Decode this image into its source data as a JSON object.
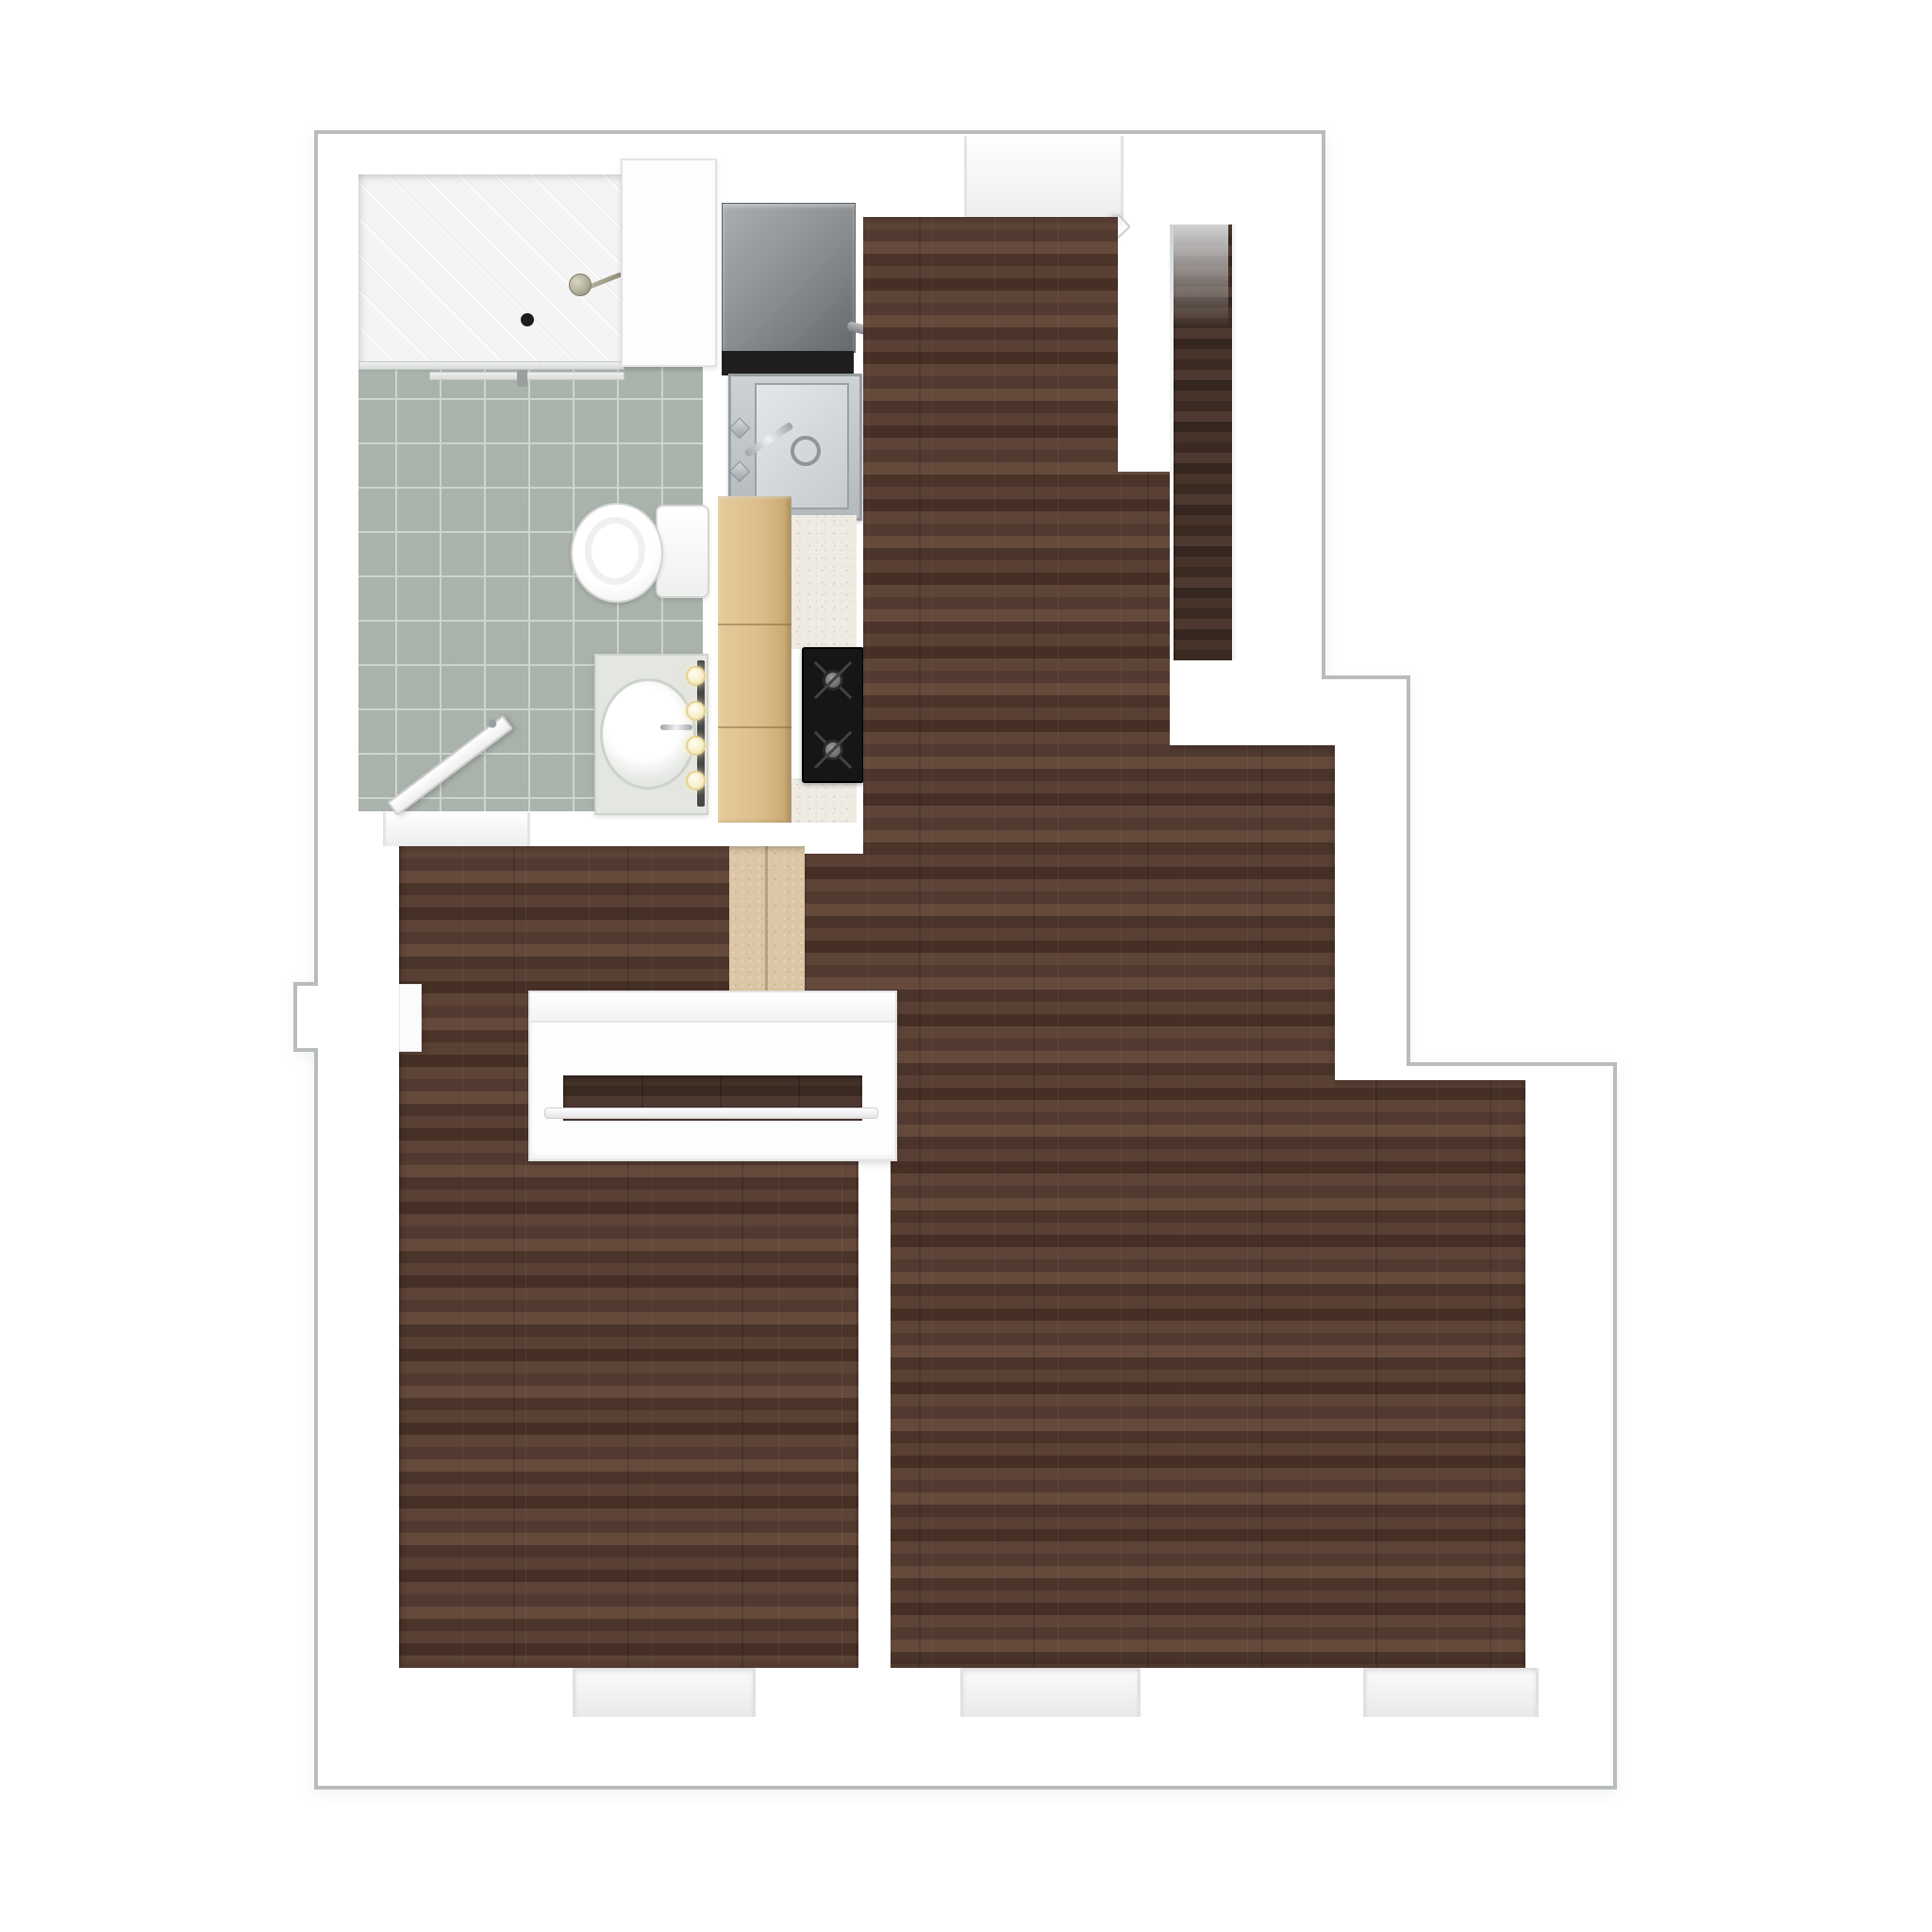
{
  "meta": {
    "title": "Apartment floor plan - 3D top-down dollhouse render",
    "render_style": "photoreal 3D floorplan, no text labels visible",
    "canvas_px": "2048x2048"
  },
  "palette": {
    "background": "#ffffff",
    "outline": "#b9bcbd",
    "wall": "#ffffff",
    "wood_floor": "#573e32",
    "wood_floor_dark": "#3f2e25",
    "tile_floor": "#a9b2ab",
    "tile_grout": "#ced4ce",
    "hall_floor_beige": "#dbc7a6",
    "cabinet_wood": "#ddc08f",
    "countertop": "#eeebe2",
    "stove_black": "#161616",
    "refrigerator_gray": "#85888b",
    "stainless_steel": "#c3c8cb",
    "shower_floor": "#f3f4f3",
    "vanity_top": "#e3e6e1",
    "vanity_bulb": "#fff3cf"
  },
  "rooms": {
    "bathroom": {
      "label": "Bathroom with gray tile floor, shower, toilet and vanity"
    },
    "kitchen": {
      "label": "Galley kitchen run with fridge, sink, cabinets and stove"
    },
    "entry": {
      "label": "Entry area with open front door"
    },
    "entry_closet": {
      "label": "Narrow entry closet with wood floor and shelf"
    },
    "living": {
      "label": "Living room with dark hardwood floor"
    },
    "bedroom": {
      "label": "Bedroom with dark hardwood floor"
    },
    "hall": {
      "label": "Hallway threshold with beige stone floor"
    }
  },
  "fixtures": {
    "shower": {
      "label": "Walk-in shower with glass sliding door"
    },
    "shower_head": {
      "label": "Shower head"
    },
    "shower_drain": {
      "label": "Shower floor drain"
    },
    "storage_cabinet": {
      "label": "Tall white bathroom cabinet"
    },
    "toilet": {
      "label": "Toilet with tank"
    },
    "vanity": {
      "label": "Vanity counter with round sink and four makeup lights"
    },
    "bathroom_door": {
      "label": "Bathroom door, open into bathroom"
    },
    "refrigerator": {
      "label": "Refrigerator"
    },
    "kitchen_sink": {
      "label": "Stainless kitchen sink with faucet"
    },
    "cabinets": {
      "label": "Birch kitchen cabinets"
    },
    "countertop": {
      "label": "Speckled countertop"
    },
    "stove": {
      "label": "Black gas stove with burners and oven handle"
    },
    "entry_door": {
      "label": "Front entry door, open inward"
    },
    "wardrobe": {
      "label": "Built-in bedroom wardrobe with hanging rod"
    },
    "radiator_niche": {
      "label": "Wall niche on bedroom exterior wall"
    }
  },
  "windows": {
    "bedroom": {
      "label": "Bedroom window recess"
    },
    "living_left": {
      "label": "Living room window recess, left"
    },
    "living_right": {
      "label": "Living room window recess, right"
    }
  }
}
